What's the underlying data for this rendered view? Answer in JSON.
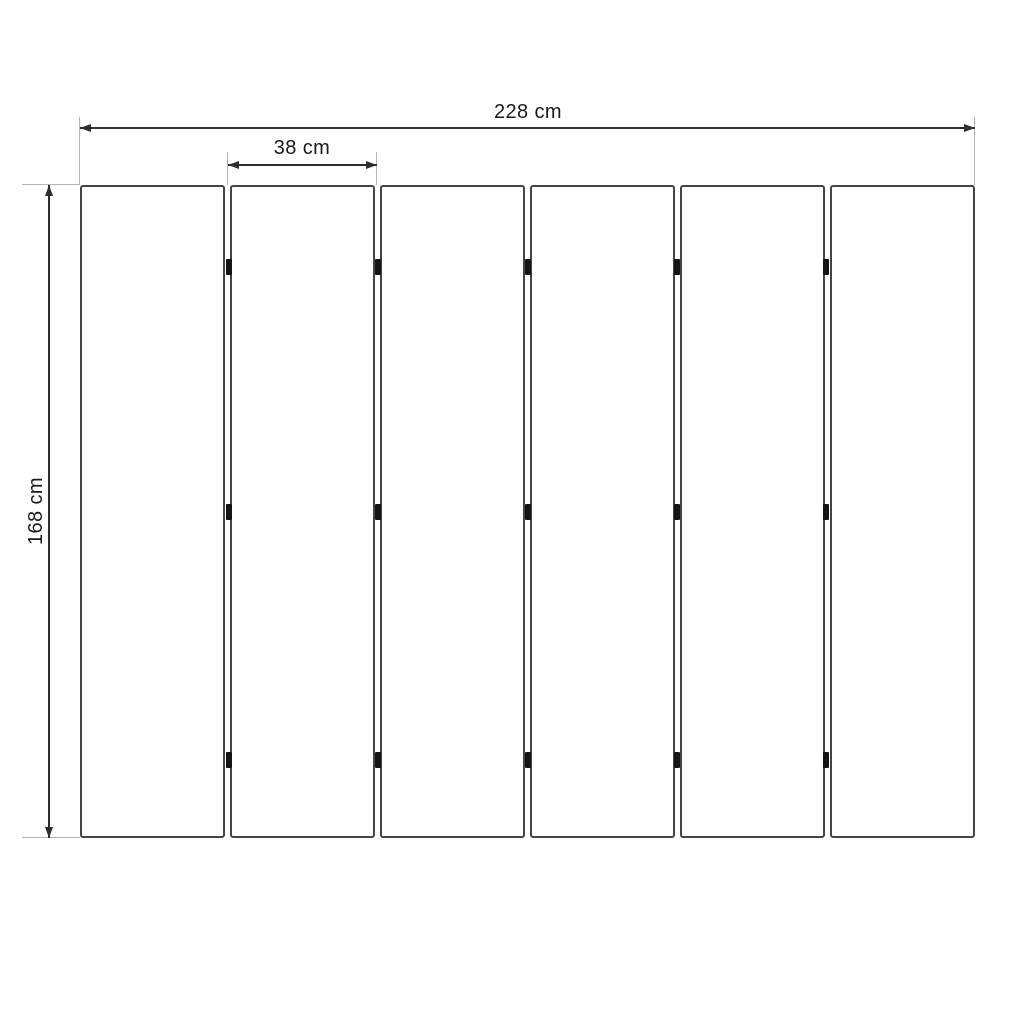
{
  "diagram": {
    "type": "technical-dimension-drawing",
    "subject": "six-panel folding screen, front elevation",
    "panels": {
      "count": 6,
      "hinge_rows_pct": [
        12.5,
        50,
        88
      ],
      "hinges_per_junction": 3
    },
    "dimensions": {
      "total_width": {
        "label": "228 cm"
      },
      "panel_width": {
        "label": "38 cm"
      },
      "height": {
        "label": "168 cm"
      }
    },
    "colors": {
      "background": "#ffffff",
      "panel_stroke": "#454545",
      "dimension_stroke": "#2d2d2d",
      "extension_stroke": "#b3b3b3",
      "hinge_fill": "#151515",
      "text": "#1a1a1a"
    }
  }
}
